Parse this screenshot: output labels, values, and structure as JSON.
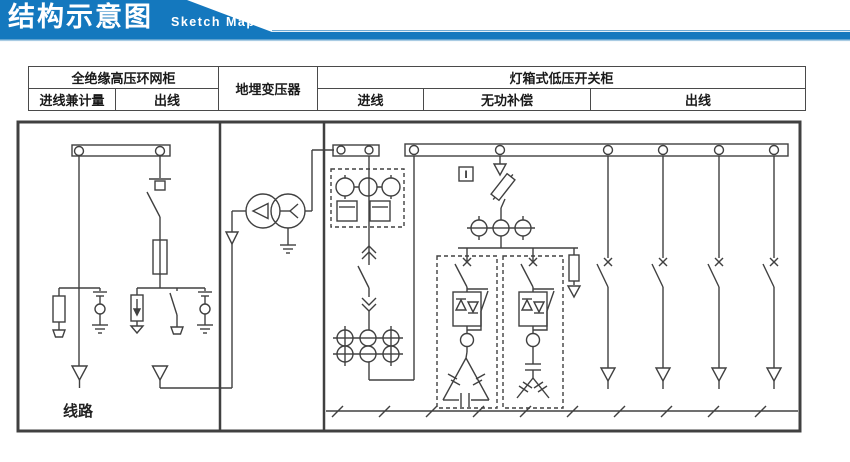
{
  "header": {
    "title": "结构示意图",
    "subtitle": "Sketch Map"
  },
  "colors": {
    "banner_blue": "#1478BE",
    "banner_light": "#8FBEDF",
    "line_gray": "#404040",
    "border_black": "#1F1F1F"
  },
  "table": {
    "hv_cabinet": "全绝缘高压环网柜",
    "hv_in_metering": "进线兼计量",
    "hv_out": "出线",
    "transformer": "地埋变压器",
    "lv_cabinet": "灯箱式低压开关柜",
    "lv_in": "进线",
    "lv_compensation": "无功补偿",
    "lv_out": "出线"
  },
  "diagram": {
    "outgoing_line_label": "线路",
    "meter_box_label": "I"
  }
}
